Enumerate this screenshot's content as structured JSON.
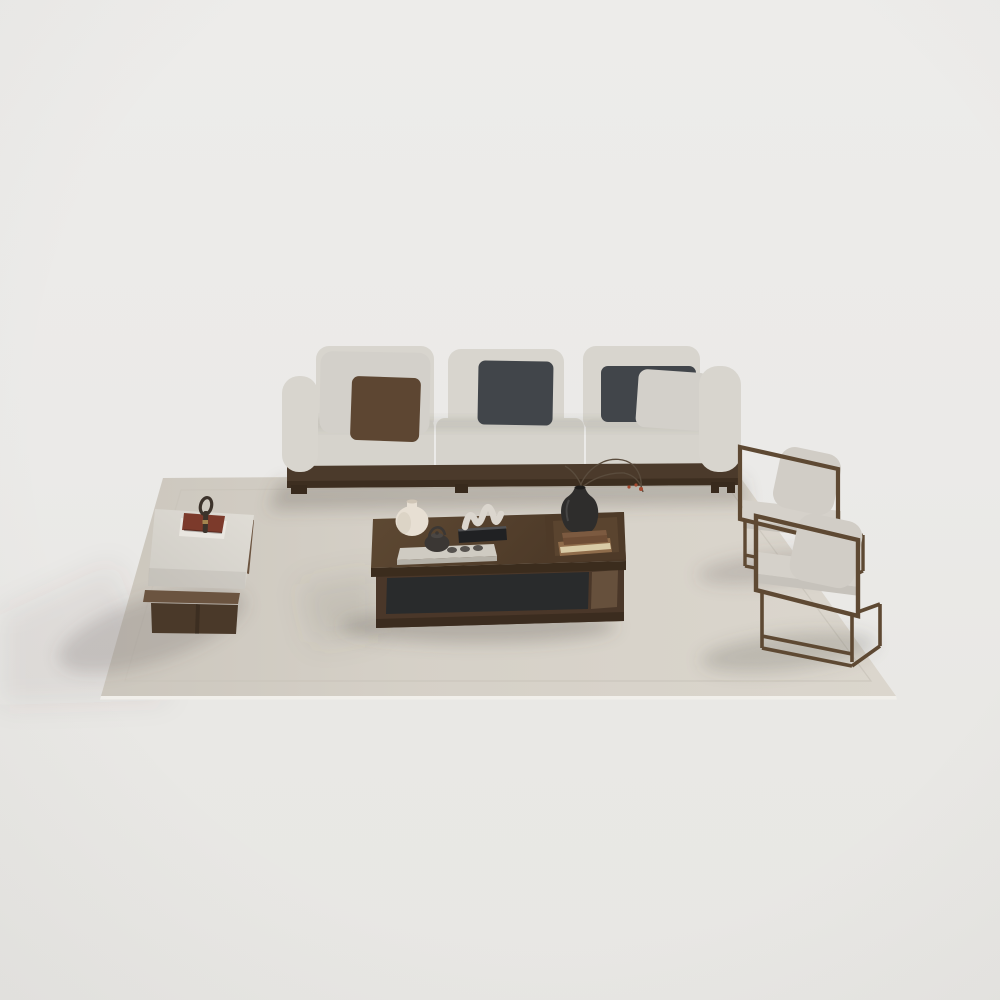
{
  "scene": {
    "title": "Modern living-room furniture set - 3D product render on seamless studio backdrop",
    "items": [
      {
        "id": "rug",
        "label": "Large beige area rug with stitched border"
      },
      {
        "id": "sofa",
        "label": "Three-seat light fabric sofa on dark wood plinth"
      },
      {
        "id": "pillow-light-left",
        "label": "Light gray back pillow, left seat"
      },
      {
        "id": "pillow-brown",
        "label": "Brown accent pillow, left seat"
      },
      {
        "id": "pillow-charcoal-center",
        "label": "Charcoal accent pillow, center seat"
      },
      {
        "id": "pillow-charcoal-right",
        "label": "Charcoal accent pillow, right seat"
      },
      {
        "id": "pillow-light-right",
        "label": "Light gray accent pillow, right seat"
      },
      {
        "id": "bench",
        "label": "Upholstered daybed bench on dark wood plinth"
      },
      {
        "id": "red-book",
        "label": "Red book with magnifying glass on bench"
      },
      {
        "id": "coffee-table",
        "label": "Low walnut coffee table with open shelf and raised tray"
      },
      {
        "id": "white-vase",
        "label": "Round cream ceramic vase"
      },
      {
        "id": "tea-set",
        "label": "Dark teapot and cups on light tea tray"
      },
      {
        "id": "sculpture",
        "label": "White wave sculpture on black base"
      },
      {
        "id": "black-vase",
        "label": "Black vase with dried branches and red berries"
      },
      {
        "id": "books",
        "label": "Two stacked hardcover books on tray"
      },
      {
        "id": "armchair-rear",
        "label": "Bronze metal-frame lounge chair, rear"
      },
      {
        "id": "armchair-front",
        "label": "Bronze metal-frame lounge chair, front"
      }
    ]
  },
  "palette": {
    "background_top": "#EDECEA",
    "background_mid": "#EBEAE8",
    "background_floor": "#E9E8E5",
    "background_bottom": "#E8E7E4",
    "shadow": "#55504A",
    "rug": "#DBD6CD",
    "rug_stitch": "#C9C4BA",
    "rug_edge_highlight": "#F1EFEA",
    "sofa_fabric": "#D8D5CE",
    "seat_fabric": "#D6D3CC",
    "pillow_light": "#D3D0CA",
    "pillow_brown": "#5D4632",
    "pillow_charcoal": "#41454A",
    "wood_base": "#4B3A2B",
    "wood_dark": "#382A1D",
    "bench_wood": "#6B5440",
    "bench_leg": "#4A3929",
    "bench_cushion_light": "#E0DDD6",
    "bench_cushion_dark": "#CFCCC5",
    "red_book": "#7C3A2B",
    "pad_white": "#E9E6E0",
    "magnifier": "#3C332B",
    "gold": "#A5854F",
    "table_top": "#4A3726",
    "table_top_light": "#5E4933",
    "table_front": "#3B2C1D",
    "table_side": "#66503C",
    "table_shelf": "#4A3729",
    "table_panel": "#292B2C",
    "tray_wood": "#4E3A28",
    "tray_inner": "#5A442F",
    "vase_white": "#E7DFD3",
    "vase_white_shade": "#C9BFAE",
    "teapot": "#3B3734",
    "tea_tray": "#CFCBC2",
    "tea_tray_edge": "#B5B1A8",
    "cup": "#56524E",
    "sculpture": "#DBD6CE",
    "sculpture_base": "#202123",
    "vase_black": "#2E2D2C",
    "branch": "#5A4C3D",
    "berry": "#A6492F",
    "book_cover_top": "#6E4D35",
    "book_cover_top_face": "#7C5A40",
    "book_cover_bottom": "#8F6C4B",
    "book_pages": "#D9CBA6",
    "chair_frame": "#5E4933",
    "chair_cushion": "#D5D1CA",
    "chair_cushion_shade": "#C6C2BB",
    "chair_pillow": "#D1CDC6"
  }
}
